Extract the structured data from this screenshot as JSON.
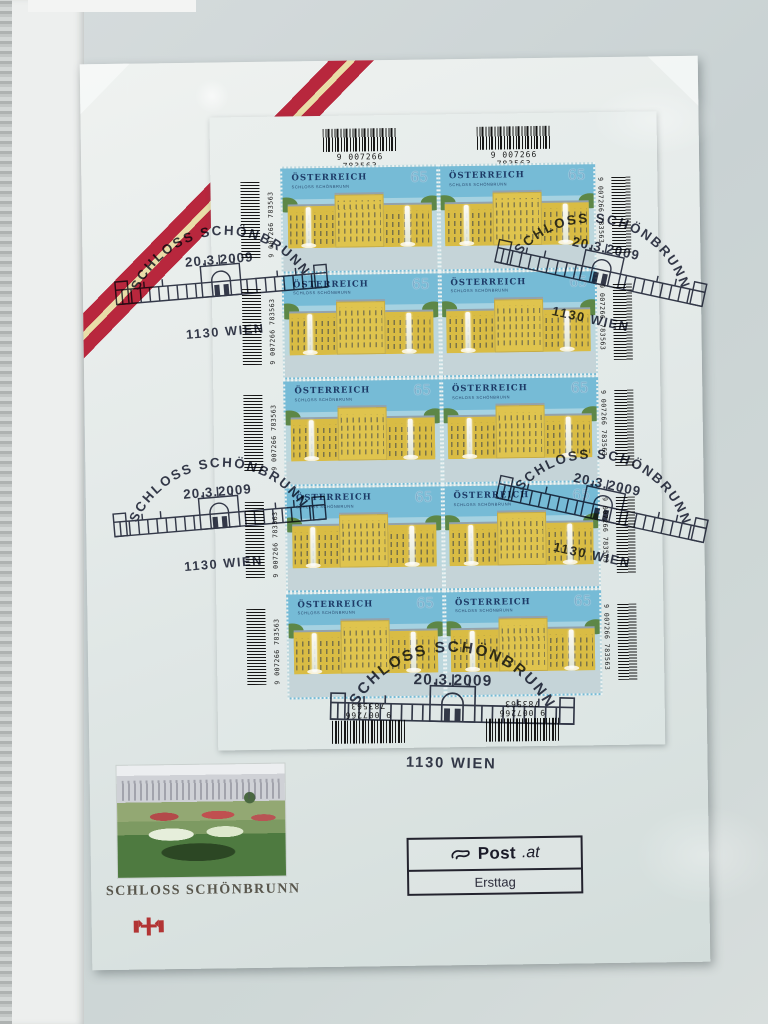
{
  "sheet": {
    "ean": "9 007266 783563",
    "stamp": {
      "country": "ÖSTERREICH",
      "subtitle": "SCHLOSS SCHÖNBRUNN",
      "denomination": "65"
    }
  },
  "postmark": {
    "location_arc": "SCHLOSS SCHÖNBRUNN",
    "date": "20.3.2009",
    "city": "1130 WIEN"
  },
  "footer": {
    "photo_caption": "SCHLOSS SCHÖNBRUNN",
    "post_logo_bold": "Post",
    "post_logo_suffix": ".at",
    "first_day_label": "Ersttag"
  },
  "colors": {
    "flag_red": "#b8273d",
    "palace_yellow": "#d9bc44",
    "stamp_sky": "#76bbd6",
    "postmark_ink": "#1d2236",
    "card_background": "#e4eae9"
  }
}
